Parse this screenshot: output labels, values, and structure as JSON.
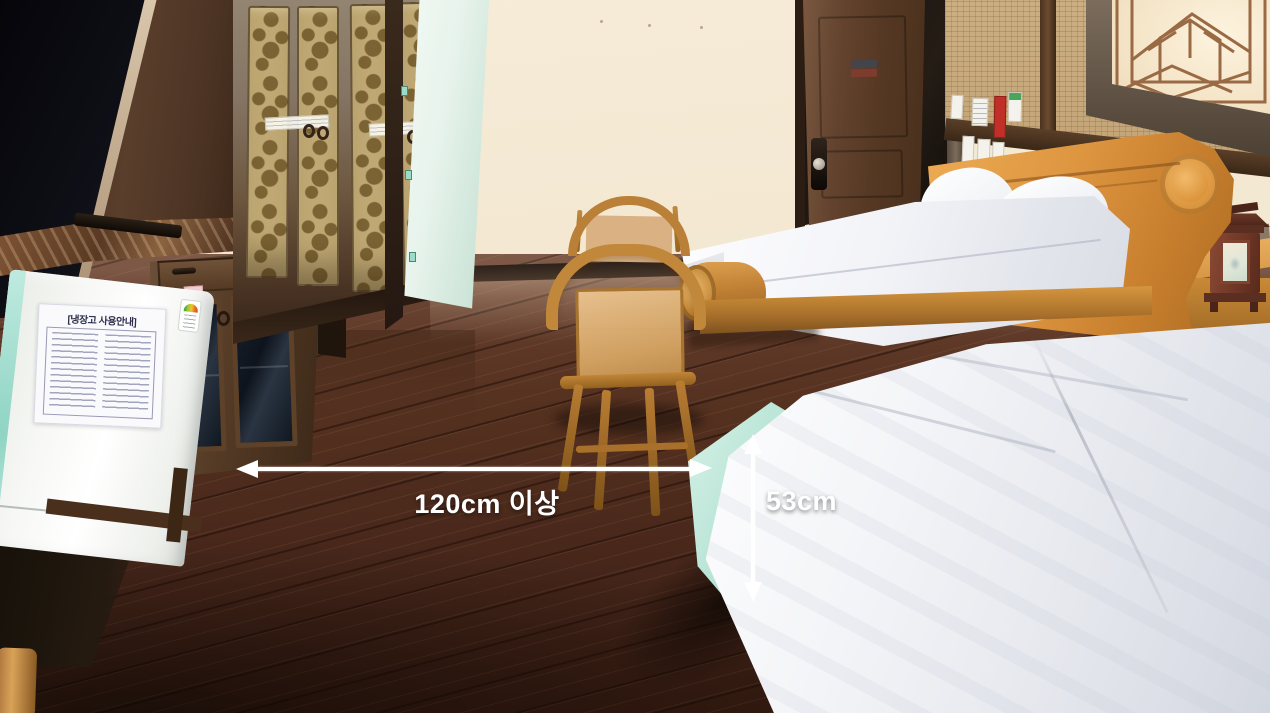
{
  "scene": {
    "setting": "hotel guest room interior photo",
    "objects": [
      "flat-screen TV",
      "TV cabinet with marble top",
      "remote control",
      "mini refrigerator",
      "refrigerator usage notice",
      "glass-door cabinet",
      "wardrobe with gold damask panels",
      "open wardrobe door",
      "wooden armchairs",
      "entrance door",
      "wall notice papers",
      "rattan wall panels",
      "decorative lattice window screen",
      "sleigh-style wooden bed",
      "white pillows",
      "white bedding",
      "round wooden footboard",
      "nightstand",
      "traditional lantern lamp",
      "low bed with mint fitted sheet and white duvet",
      "dark hardwood floor"
    ]
  },
  "annotations": {
    "width": {
      "label": "120cm 이상",
      "type": "horizontal-double-arrow"
    },
    "height": {
      "label": "53cm",
      "type": "vertical-double-arrow"
    },
    "color": "#ffffff"
  },
  "fridge": {
    "notice_title": "[냉장고 사용안내]"
  },
  "colors": {
    "wall": "#f2e6cf",
    "floor": "#54301f",
    "wardrobe_panel": "#bfa873",
    "bed_frame": "#d08a33",
    "bedding_white": "#f4f5f8",
    "mattress_mint": "#a9dccc",
    "door_wood": "#55392a",
    "annotation": "#ffffff"
  }
}
